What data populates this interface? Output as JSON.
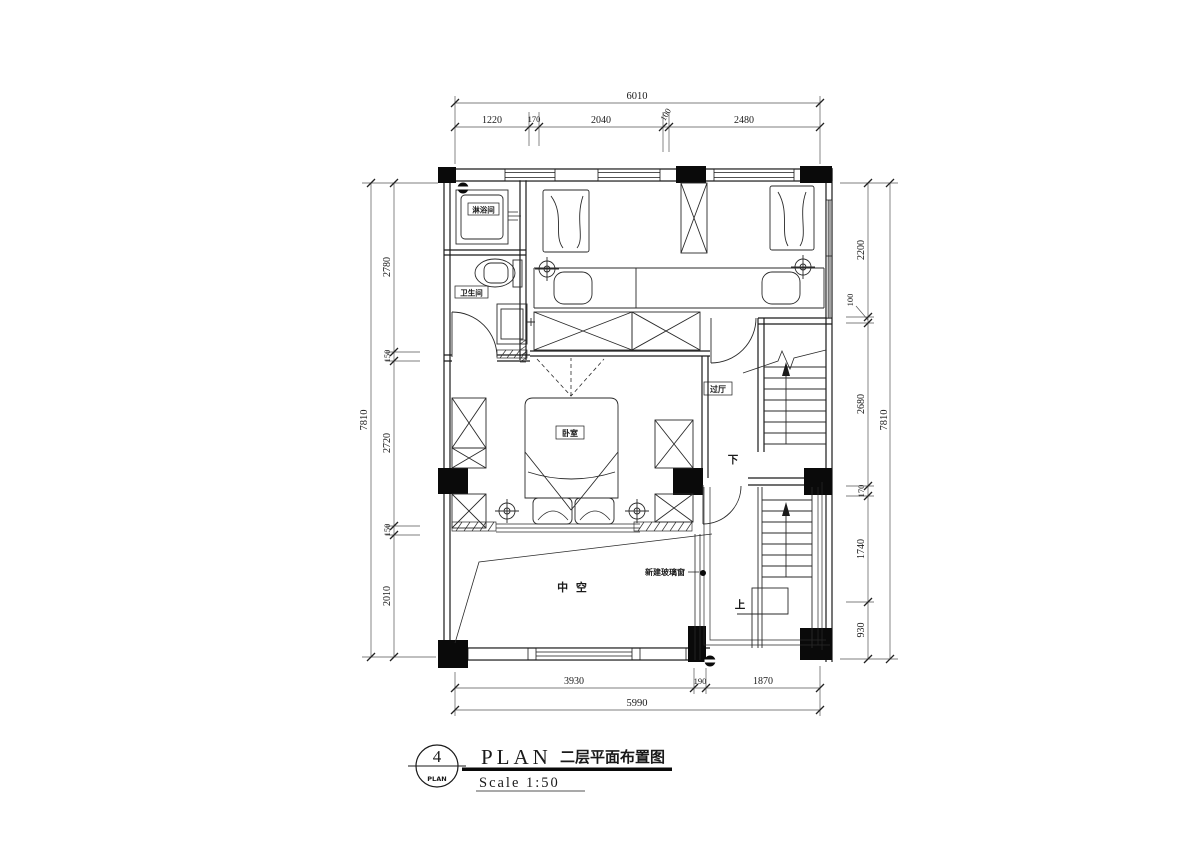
{
  "title_block": {
    "circle_number": "4",
    "circle_label": "PLAN",
    "title_en": "PLAN",
    "title_cn": "二层平面布置图",
    "scale": "Scale  1:50"
  },
  "rooms": {
    "shower": "淋浴间",
    "bathroom": "卫生间",
    "bedroom": "卧室",
    "hall": "过厅",
    "void": "中 空",
    "annotation": "新建玻璃窗",
    "stair_down": "下",
    "stair_up": "上"
  },
  "dims": {
    "top": {
      "total": "6010",
      "segments": [
        "1220",
        "170",
        "2040",
        "100",
        "2480"
      ]
    },
    "bottom": {
      "total": "5990",
      "segments": [
        "3930",
        "190",
        "1870"
      ]
    },
    "left": {
      "total": "7810",
      "segments": [
        "2780",
        "150",
        "2720",
        "150",
        "2010"
      ]
    },
    "right": {
      "total": "7810",
      "segments": [
        "2200",
        "100",
        "2680",
        "170",
        "1740",
        "930"
      ]
    }
  },
  "colors": {
    "line": "#1a1a1a",
    "dim": "#444444"
  }
}
